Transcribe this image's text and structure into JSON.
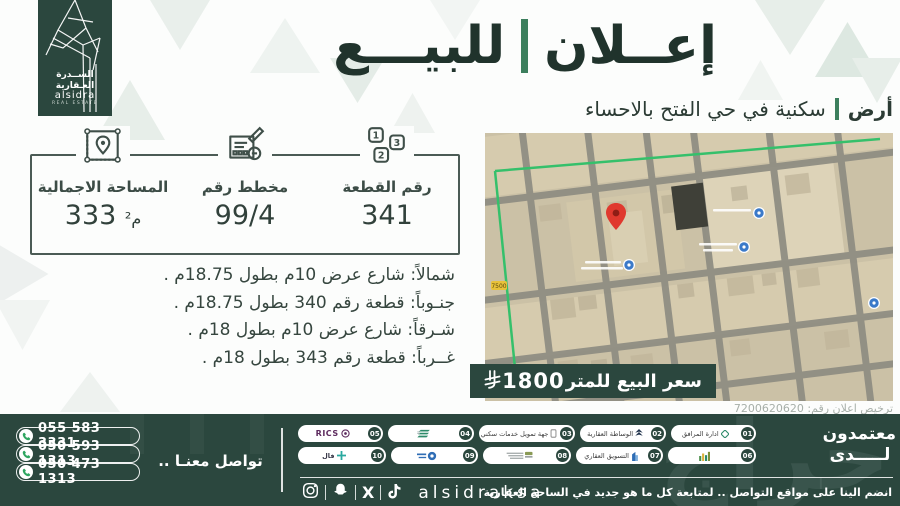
{
  "brand": {
    "name_ar_line1": "الســدرة",
    "name_ar_line2": "العـقارية",
    "name_en": "alsidra",
    "name_en_sub": "REAL ESTATE"
  },
  "header": {
    "title_word_right": "إعــلان",
    "title_word_left": "للبيـــع",
    "subtitle_tag": "أرض",
    "subtitle_text": "سكنية في حي الفتح بالاحساء"
  },
  "stats": {
    "plot": {
      "label": "رقم القطعة",
      "value": "341"
    },
    "plan": {
      "label": "مخطط رقم",
      "value": "99/4"
    },
    "area": {
      "label": "المساحة الاجمالية",
      "value": "333",
      "unit": "م²"
    }
  },
  "boundaries": {
    "north": "شمالاً: شارع عرض 10م بطول 18.75م .",
    "south": "جنـوباً:  قطعة رقم 340 بطول 18.75م .",
    "east": "شـرقاً: شارع عرض 10م  بطول 18م .",
    "west": "غــرباً: قطعة رقم 343 بطول 18م ."
  },
  "price": {
    "label": "سعر البيع للمتر",
    "value": "1800",
    "currency_icon": "saudi-riyal-symbol"
  },
  "map": {
    "route_number": "7500",
    "pin_color": "#e0392e",
    "boundary_color": "#35c06b"
  },
  "license": {
    "text": "ترخيص اعلان رقم:",
    "number": "7200620620"
  },
  "footer": {
    "contact_label": "تواصل معنـا ..",
    "phones": [
      "055 583 3331",
      "050 593 1313",
      "050 473 1313"
    ],
    "accredited_line1": "معتمدون",
    "accredited_line2": "لـــــدى",
    "badges": [
      {
        "num": "01",
        "label": "ادارة المرافق"
      },
      {
        "num": "02",
        "label": "الوساطة العقارية"
      },
      {
        "num": "03",
        "label": "جهة تمويل خدمات سكني"
      },
      {
        "num": "04",
        "label": ""
      },
      {
        "num": "05",
        "label": "RICS"
      },
      {
        "num": "06",
        "label": ""
      },
      {
        "num": "07",
        "label": "التسويق العقاري"
      },
      {
        "num": "08",
        "label": ""
      },
      {
        "num": "09",
        "label": ""
      },
      {
        "num": "10",
        "label": "فال"
      }
    ],
    "handle": "alsidraksa",
    "social_note": "انضم الينا على مواقع التواصل .. لمتابعة كل ما هو جديد في الساحة العقارية",
    "watermark": "حراج"
  },
  "colors": {
    "dark_green": "#2b473e",
    "accent_green": "#3c7f5d"
  }
}
